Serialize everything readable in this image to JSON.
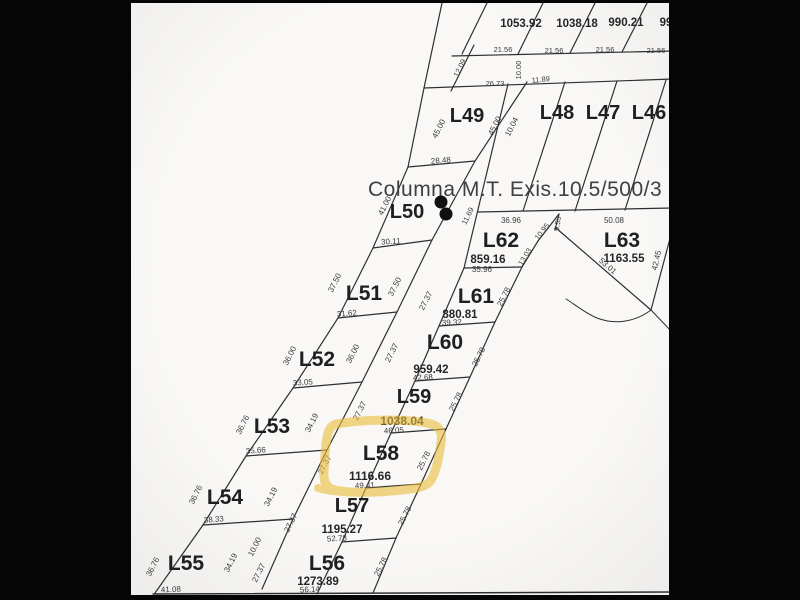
{
  "canvas": {
    "background_color": "#050505",
    "sheet_color": "#f9f8f6",
    "line_color": "#2f2f2f",
    "highlight_color": "#e9bd3a",
    "dot_color": "#111111"
  },
  "annotation": {
    "columna": "Columna M.T. Exis.10.5/500/3"
  },
  "highlight": {
    "lot": "L58",
    "style": "hand-drawn yellow marker outline"
  },
  "lot_labels": [
    {
      "text": "L49",
      "x": 467,
      "y": 122,
      "size": 20
    },
    {
      "text": "L48",
      "x": 557,
      "y": 119,
      "size": 20
    },
    {
      "text": "L47",
      "x": 603,
      "y": 119,
      "size": 20
    },
    {
      "text": "L46",
      "x": 649,
      "y": 119,
      "size": 20
    },
    {
      "text": "L50",
      "x": 407,
      "y": 218,
      "size": 20
    },
    {
      "text": "L62",
      "x": 501,
      "y": 247,
      "size": 21
    },
    {
      "text": "L63",
      "x": 622,
      "y": 247,
      "size": 21
    },
    {
      "text": "L51",
      "x": 364,
      "y": 300,
      "size": 21
    },
    {
      "text": "L61",
      "x": 476,
      "y": 303,
      "size": 21
    },
    {
      "text": "L52",
      "x": 317,
      "y": 366,
      "size": 21
    },
    {
      "text": "L60",
      "x": 445,
      "y": 349,
      "size": 21
    },
    {
      "text": "L53",
      "x": 272,
      "y": 433,
      "size": 21
    },
    {
      "text": "L59",
      "x": 414,
      "y": 403,
      "size": 20
    },
    {
      "text": "L58",
      "x": 381,
      "y": 460,
      "size": 21
    },
    {
      "text": "L54",
      "x": 225,
      "y": 504,
      "size": 21
    },
    {
      "text": "L57",
      "x": 352,
      "y": 512,
      "size": 20
    },
    {
      "text": "L55",
      "x": 186,
      "y": 570,
      "size": 21
    },
    {
      "text": "L56",
      "x": 327,
      "y": 570,
      "size": 21
    }
  ],
  "area_labels": [
    {
      "text": "1053.92",
      "x": 521,
      "y": 27,
      "size": 11.5
    },
    {
      "text": "1038.18",
      "x": 577,
      "y": 27,
      "size": 11.5
    },
    {
      "text": "990.21",
      "x": 626,
      "y": 26,
      "size": 11.5
    },
    {
      "text": "99",
      "x": 666,
      "y": 26,
      "size": 11.5
    },
    {
      "text": "859.16",
      "x": 488,
      "y": 263,
      "size": 11.5
    },
    {
      "text": "1163.55",
      "x": 624,
      "y": 262,
      "size": 11.5
    },
    {
      "text": "880.81",
      "x": 460,
      "y": 318,
      "size": 11.5
    },
    {
      "text": "959.42",
      "x": 431,
      "y": 373,
      "size": 11.5
    },
    {
      "text": "1038.04",
      "x": 402,
      "y": 425,
      "size": 12
    },
    {
      "text": "1116.66",
      "x": 370,
      "y": 480,
      "size": 12
    },
    {
      "text": "1195.27",
      "x": 342,
      "y": 533,
      "size": 11.5
    },
    {
      "text": "1273.89",
      "x": 318,
      "y": 585,
      "size": 11.5
    }
  ],
  "dim_labels": [
    {
      "text": "21.56",
      "x": 503,
      "y": 52,
      "rot": 0,
      "size": 7.5
    },
    {
      "text": "21.56",
      "x": 554,
      "y": 53,
      "rot": 0,
      "size": 7.5
    },
    {
      "text": "21.56",
      "x": 605,
      "y": 52,
      "rot": 0,
      "size": 7.5
    },
    {
      "text": "21.56",
      "x": 656,
      "y": 53,
      "rot": 0,
      "size": 7.5
    },
    {
      "text": "26.73",
      "x": 495,
      "y": 86,
      "rot": 0,
      "size": 7.5
    },
    {
      "text": "11.89",
      "x": 541,
      "y": 82,
      "rot": -6,
      "size": 7.5
    },
    {
      "text": "12.09",
      "x": 462,
      "y": 69,
      "rot": -64,
      "size": 7.5
    },
    {
      "text": "10.00",
      "x": 521,
      "y": 70,
      "rot": -90,
      "size": 7.5
    },
    {
      "text": "45.00",
      "x": 441,
      "y": 130,
      "rot": -63,
      "size": 8
    },
    {
      "text": "45.00",
      "x": 497,
      "y": 127,
      "rot": -63,
      "size": 8
    },
    {
      "text": "10.04",
      "x": 514,
      "y": 128,
      "rot": -63,
      "size": 8
    },
    {
      "text": "28.48",
      "x": 441,
      "y": 163,
      "rot": -4,
      "size": 8
    },
    {
      "text": "41.00",
      "x": 387,
      "y": 207,
      "rot": -63,
      "size": 8
    },
    {
      "text": "11.69",
      "x": 470,
      "y": 217,
      "rot": -64,
      "size": 7.5
    },
    {
      "text": "36.96",
      "x": 511,
      "y": 223,
      "rot": 0,
      "size": 8
    },
    {
      "text": "50.08",
      "x": 614,
      "y": 223,
      "rot": 0,
      "size": 8
    },
    {
      "text": "10.95",
      "x": 544,
      "y": 233,
      "rot": -52,
      "size": 7.5
    },
    {
      "text": "9.53",
      "x": 560,
      "y": 224,
      "rot": -82,
      "size": 7.5
    },
    {
      "text": "13.03",
      "x": 527,
      "y": 258,
      "rot": -58,
      "size": 7.5
    },
    {
      "text": "53.01",
      "x": 606,
      "y": 268,
      "rot": 41,
      "size": 8
    },
    {
      "text": "42.45",
      "x": 659,
      "y": 261,
      "rot": -77,
      "size": 8
    },
    {
      "text": "30.11",
      "x": 391,
      "y": 244,
      "rot": -4,
      "size": 8
    },
    {
      "text": "35.96",
      "x": 482,
      "y": 272,
      "rot": 0,
      "size": 8
    },
    {
      "text": "37.50",
      "x": 337,
      "y": 284,
      "rot": -63,
      "size": 8
    },
    {
      "text": "37.50",
      "x": 397,
      "y": 288,
      "rot": -63,
      "size": 8
    },
    {
      "text": "27.37",
      "x": 428,
      "y": 302,
      "rot": -63,
      "size": 8
    },
    {
      "text": "25.78",
      "x": 506,
      "y": 298,
      "rot": -63,
      "size": 8
    },
    {
      "text": "31.62",
      "x": 347,
      "y": 316,
      "rot": -4,
      "size": 8
    },
    {
      "text": "39.32",
      "x": 452,
      "y": 325,
      "rot": -3,
      "size": 8
    },
    {
      "text": "36.00",
      "x": 292,
      "y": 357,
      "rot": -63,
      "size": 8
    },
    {
      "text": "36.00",
      "x": 355,
      "y": 355,
      "rot": -63,
      "size": 8
    },
    {
      "text": "27.37",
      "x": 394,
      "y": 354,
      "rot": -63,
      "size": 8
    },
    {
      "text": "25.78",
      "x": 481,
      "y": 358,
      "rot": -63,
      "size": 8
    },
    {
      "text": "33.05",
      "x": 303,
      "y": 385,
      "rot": -4,
      "size": 8
    },
    {
      "text": "42.68",
      "x": 423,
      "y": 380,
      "rot": -3,
      "size": 8
    },
    {
      "text": "36.76",
      "x": 245,
      "y": 426,
      "rot": -63,
      "size": 8
    },
    {
      "text": "34.19",
      "x": 314,
      "y": 424,
      "rot": -63,
      "size": 8
    },
    {
      "text": "27.37",
      "x": 362,
      "y": 412,
      "rot": -63,
      "size": 8
    },
    {
      "text": "25.78",
      "x": 458,
      "y": 403,
      "rot": -63,
      "size": 8
    },
    {
      "text": "35.66",
      "x": 256,
      "y": 453,
      "rot": -4,
      "size": 8
    },
    {
      "text": "46.05",
      "x": 394,
      "y": 433,
      "rot": -3,
      "size": 8
    },
    {
      "text": "27.37",
      "x": 327,
      "y": 466,
      "rot": -63,
      "size": 8
    },
    {
      "text": "25.78",
      "x": 426,
      "y": 462,
      "rot": -63,
      "size": 8
    },
    {
      "text": "36.76",
      "x": 198,
      "y": 496,
      "rot": -63,
      "size": 8
    },
    {
      "text": "34.19",
      "x": 273,
      "y": 498,
      "rot": -63,
      "size": 8
    },
    {
      "text": "49.41",
      "x": 365,
      "y": 488,
      "rot": -3,
      "size": 8
    },
    {
      "text": "27.37",
      "x": 293,
      "y": 524,
      "rot": -63,
      "size": 8
    },
    {
      "text": "25.78",
      "x": 407,
      "y": 517,
      "rot": -63,
      "size": 8
    },
    {
      "text": "38.33",
      "x": 214,
      "y": 522,
      "rot": -4,
      "size": 8
    },
    {
      "text": "52.78",
      "x": 337,
      "y": 541,
      "rot": -3,
      "size": 8
    },
    {
      "text": "10.00",
      "x": 257,
      "y": 548,
      "rot": -63,
      "size": 8
    },
    {
      "text": "36.76",
      "x": 155,
      "y": 568,
      "rot": -63,
      "size": 8
    },
    {
      "text": "34.19",
      "x": 233,
      "y": 564,
      "rot": -63,
      "size": 8
    },
    {
      "text": "27.37",
      "x": 261,
      "y": 574,
      "rot": -63,
      "size": 8
    },
    {
      "text": "25.78",
      "x": 383,
      "y": 568,
      "rot": -63,
      "size": 8
    },
    {
      "text": "41.08",
      "x": 171,
      "y": 592,
      "rot": -3,
      "size": 8
    },
    {
      "text": "56.14",
      "x": 310,
      "y": 592,
      "rot": -3,
      "size": 8
    }
  ]
}
